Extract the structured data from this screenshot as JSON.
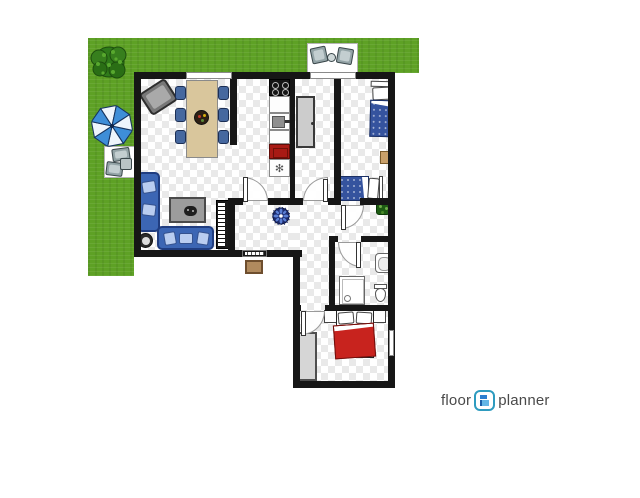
{
  "watermark": {
    "brand_left": "floor",
    "brand_right": "planner",
    "icon_name": "floorplanner-logo-icon"
  },
  "glyphs": {
    "fridge_fan": "✻"
  },
  "colors": {
    "grass": "#5ea125",
    "tree_green": "#2f7a1a",
    "wall": "#161616",
    "floor_check": "#e9e9e9",
    "sofa_blue": "#3c66b4",
    "pillow_blue": "#b9cdf0",
    "bed_blue": "#35539e",
    "bed_red": "#c8231e",
    "wood": "#d9c69c",
    "island_gray": "#cccccc",
    "stove_red": "#a81a14",
    "umbrella_blue": "#3e8ed8",
    "plant_green": "#1e5c14",
    "doormat_tan": "#b08a5e",
    "logo_teal": "#2e9bbf",
    "logo_text": "#4a4a4a"
  }
}
